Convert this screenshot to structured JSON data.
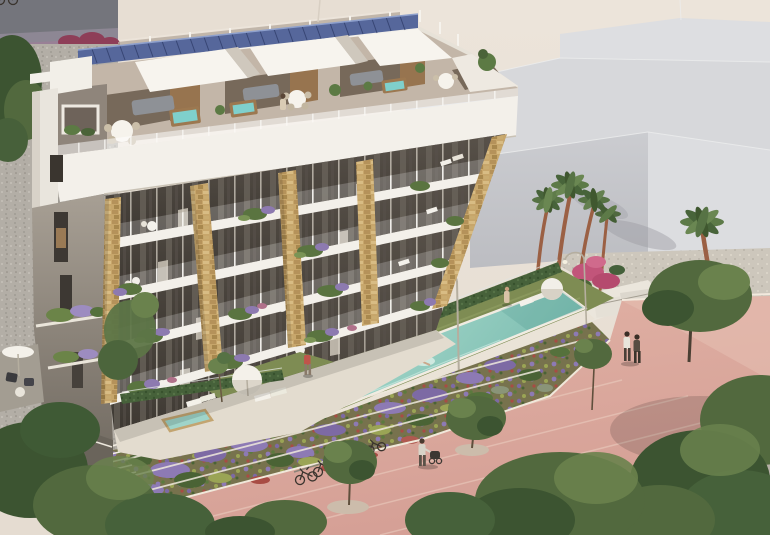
{
  "meta": {
    "type": "architectural-render",
    "description": "Aerial 3D render of a six-storey white residential building with rooftop solar panels, stone-clad pillars, planted balconies, penthouse terraces with hot tubs, a turquoise lap pool with swimmer, terraced flower gardens, parked bicycles, palm trees and a pink paved promenade with pedestrians"
  },
  "palette": {
    "backdrop": "#eae2d8",
    "bgGray": "#74757c",
    "bgGrayBand": "#8d8794",
    "bgPurple": "#9b7f96",
    "bgMagenta": "#8e3e58",
    "boxTop": "#d7d8db",
    "boxFront": "#c7c8cc",
    "boxRight": "#dcdde0",
    "eaveShadow": "#b6aa9d",
    "gravelLeft": "#b3aea6",
    "gravelRight": "#cdc7bc",
    "solar": "#56679b",
    "solarDark": "#32406e",
    "white": "#f3f0ea",
    "whiteShade": "#ddd7cc",
    "penthouse": "#c3b6a8",
    "recess": "#77695a",
    "wood": "#97744f",
    "core": "#8f857b",
    "bay": "#45403a",
    "glass": "#6c655c",
    "curtain": "#d5cec1",
    "stone": "#c7a66b",
    "stoneDark": "#a8884e",
    "hedge": "#46613a",
    "lawn": "#7e8c53",
    "pool": "#9fd1c5",
    "poolDeep": "#6fb2a6",
    "deck": "#eae3d7",
    "prom": "#dcab9f",
    "promLight": "#ecd0c2",
    "gardenBase": "#77724d",
    "lavender": "#8d7ab4",
    "flowerRed": "#a84c44",
    "flowerYellow": "#a3a85a",
    "treeDark": "#3c5431",
    "treeMid": "#52693e",
    "treeLight": "#6a824d",
    "palmTrunk": "#9b6044",
    "frond": "#567244",
    "lamp": "#b5ae9f",
    "dark": "#3a342e",
    "sofa": "#8e9196",
    "tubWood": "#9c7850",
    "tubWater": "#7fd0cc",
    "skinTan": "#c8a080",
    "shirtRed": "#c0544a",
    "shirtWhite": "#e8e4da",
    "street": "#b7b1a8"
  },
  "scene": {
    "objects": [
      "apartment-building",
      "solar-panel-array",
      "penthouse-terraces",
      "hot-tubs",
      "stone-pillars",
      "balconies-with-plants",
      "lap-pool",
      "swimmer",
      "plunge-pool",
      "sun-loungers",
      "parasols",
      "hedge-fence",
      "lawn",
      "terraced-flower-gardens",
      "bicycle-rack",
      "pink-promenade",
      "street-lamps",
      "palm-trees",
      "street-trees",
      "pedestrians",
      "background-buildings",
      "gravel-lots"
    ]
  }
}
